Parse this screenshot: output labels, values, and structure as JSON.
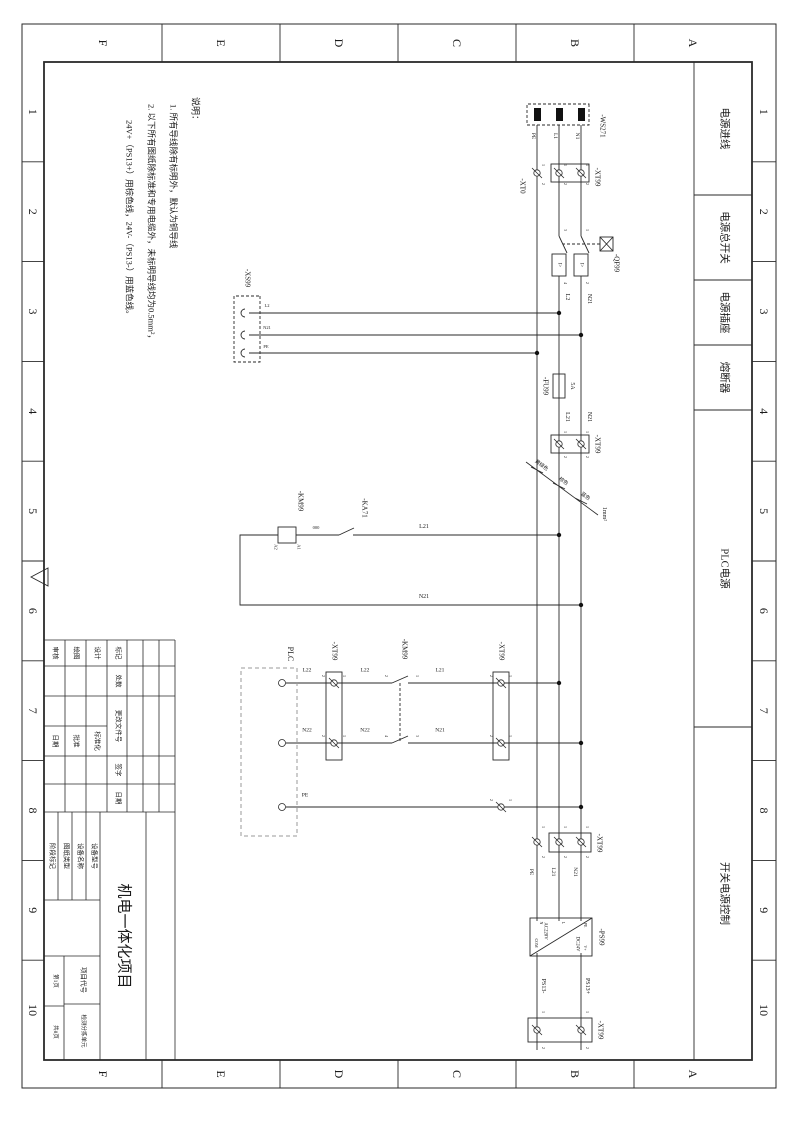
{
  "document": {
    "kind": "electrical-schematic-sheet",
    "orientation": "landscape-rotated-90cw"
  },
  "frame": {
    "letters": [
      "A",
      "B",
      "C",
      "D",
      "E",
      "F"
    ],
    "numbers": [
      "1",
      "2",
      "3",
      "4",
      "5",
      "6",
      "7",
      "8",
      "9",
      "10"
    ]
  },
  "sections": [
    {
      "label": "电源进线",
      "x1": 62,
      "x2": 195
    },
    {
      "label": "电源总开关",
      "x1": 195,
      "x2": 280
    },
    {
      "label": "电源插座",
      "x1": 280,
      "x2": 345
    },
    {
      "label": "熔断器",
      "x1": 345,
      "x2": 410
    },
    {
      "label": "PLC电源",
      "x1": 410,
      "x2": 727
    },
    {
      "label": "开关电源控制",
      "x1": 727,
      "x2": 1060
    }
  ],
  "notes": {
    "heading": "说明：",
    "lines": [
      "1. 所有导线除有标明外，默认为铜导线",
      "2. 以下所有图纸除标准和专用电缆外，未标明导线均为0.5mm²，",
      "24V+（PS13+）用棕色线，24V-（PS13-）用蓝色线。"
    ]
  },
  "schematic": {
    "labels": [
      {
        "t": "-WS271",
        "x": 126,
        "y": 192,
        "s": 7,
        "n": "component-label"
      },
      {
        "t": "N1",
        "x": 136,
        "y": 218,
        "s": 5.5,
        "n": "wire-label"
      },
      {
        "t": "L1",
        "x": 136,
        "y": 240,
        "s": 5.5,
        "n": "wire-label"
      },
      {
        "t": "PE",
        "x": 136,
        "y": 262,
        "s": 5.5,
        "n": "wire-label"
      },
      {
        "t": "-XT0",
        "x": 186,
        "y": 272,
        "s": 7,
        "n": "component-label"
      },
      {
        "t": "-XT99",
        "x": 177,
        "y": 197,
        "s": 7,
        "n": "component-label"
      },
      {
        "t": "-QF99",
        "x": 263,
        "y": 178,
        "s": 7,
        "n": "component-label"
      },
      {
        "t": "I>",
        "x": 265,
        "y": 213,
        "s": 5,
        "n": "breaker-trip-label"
      },
      {
        "t": "I>",
        "x": 265,
        "y": 235,
        "s": 5,
        "n": "breaker-trip-label"
      },
      {
        "t": "L2",
        "x": 297,
        "y": 227,
        "s": 6,
        "n": "wire-label"
      },
      {
        "t": "N21",
        "x": 299,
        "y": 205,
        "s": 6,
        "n": "wire-label"
      },
      {
        "t": "-XS99",
        "x": 278,
        "y": 547,
        "s": 7,
        "n": "component-label"
      },
      {
        "t": "L2",
        "x": 306,
        "y": 527,
        "s": 4.5,
        "r": -90,
        "n": "wire-label"
      },
      {
        "t": "N21",
        "x": 328,
        "y": 527,
        "s": 4.5,
        "r": -90,
        "n": "wire-label"
      },
      {
        "t": "PE",
        "x": 347,
        "y": 528,
        "s": 4.5,
        "r": -90,
        "n": "wire-label"
      },
      {
        "t": "5A",
        "x": 386,
        "y": 222,
        "s": 6,
        "n": "fuse-rating-label"
      },
      {
        "t": "-FU99",
        "x": 386,
        "y": 249,
        "s": 7,
        "n": "component-label"
      },
      {
        "t": "L21",
        "x": 417,
        "y": 227,
        "s": 6,
        "n": "wire-label"
      },
      {
        "t": "N21",
        "x": 417,
        "y": 205,
        "s": 6,
        "n": "wire-label"
      },
      {
        "t": "-XT99",
        "x": 444,
        "y": 197,
        "s": 7,
        "n": "component-label"
      },
      {
        "t": "黄绿色",
        "x": 466,
        "y": 253,
        "s": 5,
        "r": -54,
        "n": "wire-color-label"
      },
      {
        "t": "棕色",
        "x": 482,
        "y": 231,
        "s": 5,
        "r": -54,
        "n": "wire-color-label"
      },
      {
        "t": "蓝色",
        "x": 497,
        "y": 209,
        "s": 5,
        "r": -54,
        "n": "wire-color-label"
      },
      {
        "t": "1mm²",
        "x": 514,
        "y": 190,
        "s": 6,
        "n": "wire-gauge-label"
      },
      {
        "t": "L21",
        "x": 527,
        "y": 370,
        "s": 6,
        "r": -90,
        "n": "wire-label"
      },
      {
        "t": "N21",
        "x": 597,
        "y": 370,
        "s": 6,
        "r": -90,
        "n": "wire-label"
      },
      {
        "t": "-KA71",
        "x": 508,
        "y": 430,
        "s": 7,
        "n": "component-label"
      },
      {
        "t": "000",
        "x": 528,
        "y": 478,
        "s": 4.5,
        "r": -90,
        "n": "wire-label"
      },
      {
        "t": "-KM99",
        "x": 501,
        "y": 494,
        "s": 7,
        "n": "component-label"
      },
      {
        "t": "A1",
        "x": 547,
        "y": 496,
        "s": 4.5,
        "n": "terminal-label"
      },
      {
        "t": "A2",
        "x": 547,
        "y": 519,
        "s": 4.5,
        "n": "terminal-label"
      },
      {
        "t": "PLC",
        "x": 654,
        "y": 504,
        "s": 8,
        "n": "component-label"
      },
      {
        "t": "L22",
        "x": 671,
        "y": 487,
        "s": 5.5,
        "r": -90,
        "n": "wire-label"
      },
      {
        "t": "N22",
        "x": 731,
        "y": 487,
        "s": 5.5,
        "r": -90,
        "n": "wire-label"
      },
      {
        "t": "PE",
        "x": 796,
        "y": 489,
        "s": 5.5,
        "r": -90,
        "n": "wire-label"
      },
      {
        "t": "-XT99",
        "x": 651,
        "y": 460,
        "s": 7,
        "n": "component-label"
      },
      {
        "t": "L22",
        "x": 671,
        "y": 429,
        "s": 5.5,
        "r": -90,
        "n": "wire-label"
      },
      {
        "t": "N22",
        "x": 731,
        "y": 429,
        "s": 5.5,
        "r": -90,
        "n": "wire-label"
      },
      {
        "t": "-KM99",
        "x": 649,
        "y": 390,
        "s": 7,
        "n": "component-label"
      },
      {
        "t": "L21",
        "x": 671,
        "y": 354,
        "s": 5.5,
        "r": -90,
        "n": "wire-label"
      },
      {
        "t": "N21",
        "x": 731,
        "y": 354,
        "s": 5.5,
        "r": -90,
        "n": "wire-label"
      },
      {
        "t": "-XT99",
        "x": 651,
        "y": 293,
        "s": 7,
        "n": "component-label"
      },
      {
        "t": "-XT99",
        "x": 843,
        "y": 195,
        "s": 7,
        "n": "component-label"
      },
      {
        "t": "N21",
        "x": 872,
        "y": 220,
        "s": 5.5,
        "n": "wire-label"
      },
      {
        "t": "L21",
        "x": 872,
        "y": 242,
        "s": 5.5,
        "n": "wire-label"
      },
      {
        "t": "PE",
        "x": 872,
        "y": 264,
        "s": 5.5,
        "n": "wire-label"
      },
      {
        "t": "-PS99",
        "x": 937,
        "y": 193,
        "s": 7,
        "n": "component-label"
      },
      {
        "t": "AC220V",
        "x": 931,
        "y": 250,
        "s": 4.8,
        "n": "power-supply-input-label"
      },
      {
        "t": "DC24V",
        "x": 944,
        "y": 218,
        "s": 4.8,
        "n": "power-supply-output-label"
      },
      {
        "t": "PE",
        "x": 925,
        "y": 209,
        "s": 4,
        "n": "pin-label"
      },
      {
        "t": "L",
        "x": 923,
        "y": 231,
        "s": 4,
        "n": "pin-label"
      },
      {
        "t": "N",
        "x": 923,
        "y": 253,
        "s": 4,
        "n": "pin-label"
      },
      {
        "t": "V+",
        "x": 948,
        "y": 209,
        "s": 4,
        "n": "pin-label"
      },
      {
        "t": "COM",
        "x": 943,
        "y": 258,
        "s": 4,
        "n": "pin-label"
      },
      {
        "t": "PS13+",
        "x": 986,
        "y": 207,
        "s": 6,
        "n": "wire-label"
      },
      {
        "t": "PS13-",
        "x": 986,
        "y": 251,
        "s": 6,
        "n": "wire-label"
      },
      {
        "t": "-XT99",
        "x": 1030,
        "y": 194,
        "s": 7,
        "n": "component-label"
      }
    ],
    "terminal_numbers": [
      {
        "t": "1",
        "x": 230,
        "y": 207
      },
      {
        "t": "2",
        "x": 283,
        "y": 207
      },
      {
        "t": "3",
        "x": 230,
        "y": 229
      },
      {
        "t": "4",
        "x": 283,
        "y": 229
      },
      {
        "t": "1",
        "x": 165,
        "y": 207
      },
      {
        "t": "2",
        "x": 184,
        "y": 207
      },
      {
        "t": "1",
        "x": 165,
        "y": 229
      },
      {
        "t": "2",
        "x": 184,
        "y": 229
      },
      {
        "t": "1",
        "x": 165,
        "y": 251
      },
      {
        "t": "2",
        "x": 184,
        "y": 251
      },
      {
        "t": "1",
        "x": 432,
        "y": 207
      },
      {
        "t": "2",
        "x": 457,
        "y": 207
      },
      {
        "t": "1",
        "x": 432,
        "y": 229
      },
      {
        "t": "2",
        "x": 457,
        "y": 229
      },
      {
        "t": "1",
        "x": 676,
        "y": 450
      },
      {
        "t": "2",
        "x": 676,
        "y": 471
      },
      {
        "t": "1",
        "x": 736,
        "y": 450
      },
      {
        "t": "2",
        "x": 736,
        "y": 471
      },
      {
        "t": "1",
        "x": 676,
        "y": 284
      },
      {
        "t": "2",
        "x": 676,
        "y": 303
      },
      {
        "t": "1",
        "x": 736,
        "y": 284
      },
      {
        "t": "2",
        "x": 736,
        "y": 303
      },
      {
        "t": "1",
        "x": 800,
        "y": 284
      },
      {
        "t": "2",
        "x": 800,
        "y": 303
      },
      {
        "t": "1",
        "x": 676,
        "y": 377
      },
      {
        "t": "2",
        "x": 676,
        "y": 408
      },
      {
        "t": "3",
        "x": 736,
        "y": 377
      },
      {
        "t": "4",
        "x": 736,
        "y": 408
      },
      {
        "t": "1",
        "x": 827,
        "y": 207
      },
      {
        "t": "2",
        "x": 857,
        "y": 207
      },
      {
        "t": "1",
        "x": 827,
        "y": 229
      },
      {
        "t": "2",
        "x": 857,
        "y": 229
      },
      {
        "t": "1",
        "x": 827,
        "y": 251
      },
      {
        "t": "2",
        "x": 857,
        "y": 251
      },
      {
        "t": "1",
        "x": 1012,
        "y": 207
      },
      {
        "t": "2",
        "x": 1048,
        "y": 207
      },
      {
        "t": "1",
        "x": 1012,
        "y": 251
      },
      {
        "t": "2",
        "x": 1048,
        "y": 251
      }
    ]
  },
  "title_block": {
    "title": {
      "t": "机电一体化项目",
      "x": 936,
      "y": 671,
      "s": 15,
      "n": "sheet-title"
    },
    "fields": [
      {
        "t": "标记",
        "x": 653,
        "y": 677
      },
      {
        "t": "处数",
        "x": 681,
        "y": 677
      },
      {
        "t": "更改文件号",
        "x": 726,
        "y": 677
      },
      {
        "t": "签字",
        "x": 770,
        "y": 677
      },
      {
        "t": "日期",
        "x": 798,
        "y": 677
      },
      {
        "t": "设计",
        "x": 653,
        "y": 698
      },
      {
        "t": "标准化",
        "x": 741,
        "y": 698
      },
      {
        "t": "绘图",
        "x": 653,
        "y": 719
      },
      {
        "t": "批准",
        "x": 741,
        "y": 719
      },
      {
        "t": "审核",
        "x": 653,
        "y": 740
      },
      {
        "t": "日期",
        "x": 741,
        "y": 740
      },
      {
        "t": "设备型号",
        "x": 856,
        "y": 701
      },
      {
        "t": "设备名称",
        "x": 856,
        "y": 715
      },
      {
        "t": "图纸类型",
        "x": 856,
        "y": 729
      },
      {
        "t": "阶段标记",
        "x": 856,
        "y": 743
      },
      {
        "t": "项目代号",
        "x": 980,
        "y": 712
      },
      {
        "t": "检测分拣单元",
        "x": 1031,
        "y": 712,
        "s": 5.5,
        "n": "unit-name"
      },
      {
        "t": "第1页",
        "x": 981,
        "y": 740,
        "s": 5.5,
        "n": "page-number"
      },
      {
        "t": "共8页",
        "x": 1032,
        "y": 740,
        "s": 5.5,
        "n": "page-count"
      }
    ]
  }
}
